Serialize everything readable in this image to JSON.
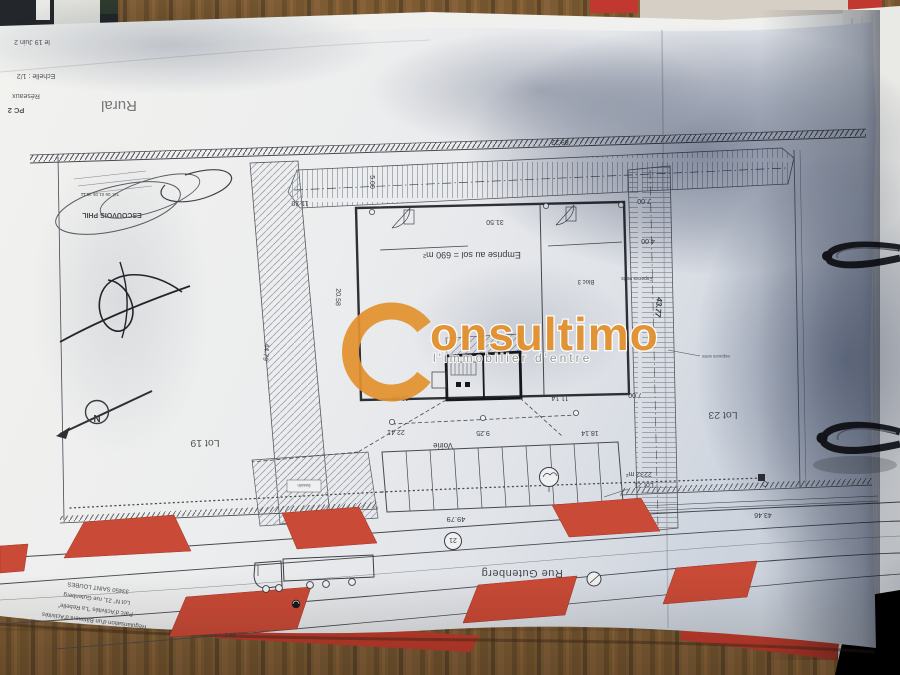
{
  "header": {
    "date_note": "le 19 Juin 2",
    "scale": "Echelle : 1/2",
    "reseaux": "Réseaux",
    "pc": "PC 2",
    "zone": "Rural"
  },
  "stamp": {
    "name": "ESCOUVOIS PHIL",
    "phone": "Tél. 06 01 05 29 11"
  },
  "plan": {
    "emprise": "Emprise au sol = 690 m²",
    "bloc": "Bloc 3",
    "voirie": "Voirie",
    "espaces_verts": "Espaces verts",
    "note_green": "espaces verts",
    "note_bassin": "bassin",
    "lot19": "Lot 19",
    "lot21": "Lot 21",
    "lot21_area": "2232 m²",
    "lot23": "Lot 23",
    "north_letter": "N"
  },
  "dims": {
    "d89": "89.22",
    "d1130": "11.30",
    "d3150": "31.50",
    "d500": "5.00",
    "d700": "7.00",
    "d400": "4.00",
    "d4479": "44.79",
    "d2058": "20.58",
    "d4377": "43.77",
    "d2241": "22.41",
    "d925": "9.25",
    "d1114": "11.14",
    "d1814": "18.14",
    "d4979": "49.79",
    "d4346": "43.46",
    "d392": "39.2"
  },
  "road": {
    "name": "Rue Gutenberg",
    "number": "21"
  },
  "title_block": {
    "line1": "Régularisation d'un Bâtiment d'Activités",
    "line2": "Parc d'Activités \"La Rebelle\"",
    "line3": "Lot N° 21, rue Gutenberg",
    "line4": "33450 SAINT LOUBES"
  },
  "watermark": {
    "brand_rest": "onsultimo",
    "tagline": "l'immobilier d'entre",
    "brand_color": "#e2912e"
  }
}
